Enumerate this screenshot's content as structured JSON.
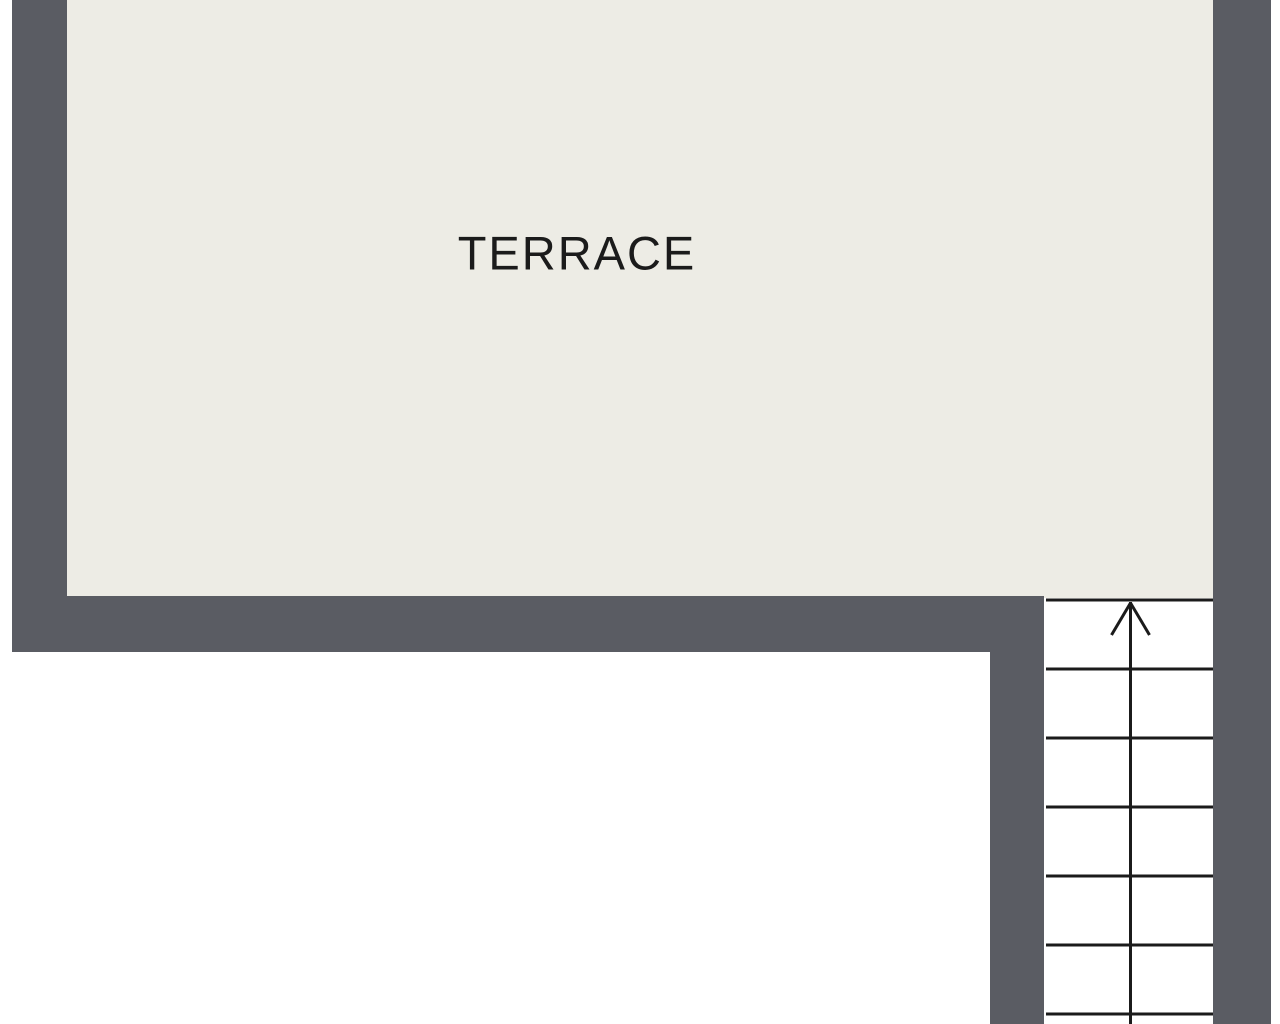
{
  "rooms": [
    {
      "label": "TERRACE"
    }
  ],
  "stairs": {
    "tread_count": 7,
    "direction": "up",
    "icon": "arrow-up-icon"
  },
  "colors": {
    "wall": "#5a5c63",
    "floor": "#edece5",
    "line": "#1b1b1b",
    "background": "#ffffff"
  }
}
